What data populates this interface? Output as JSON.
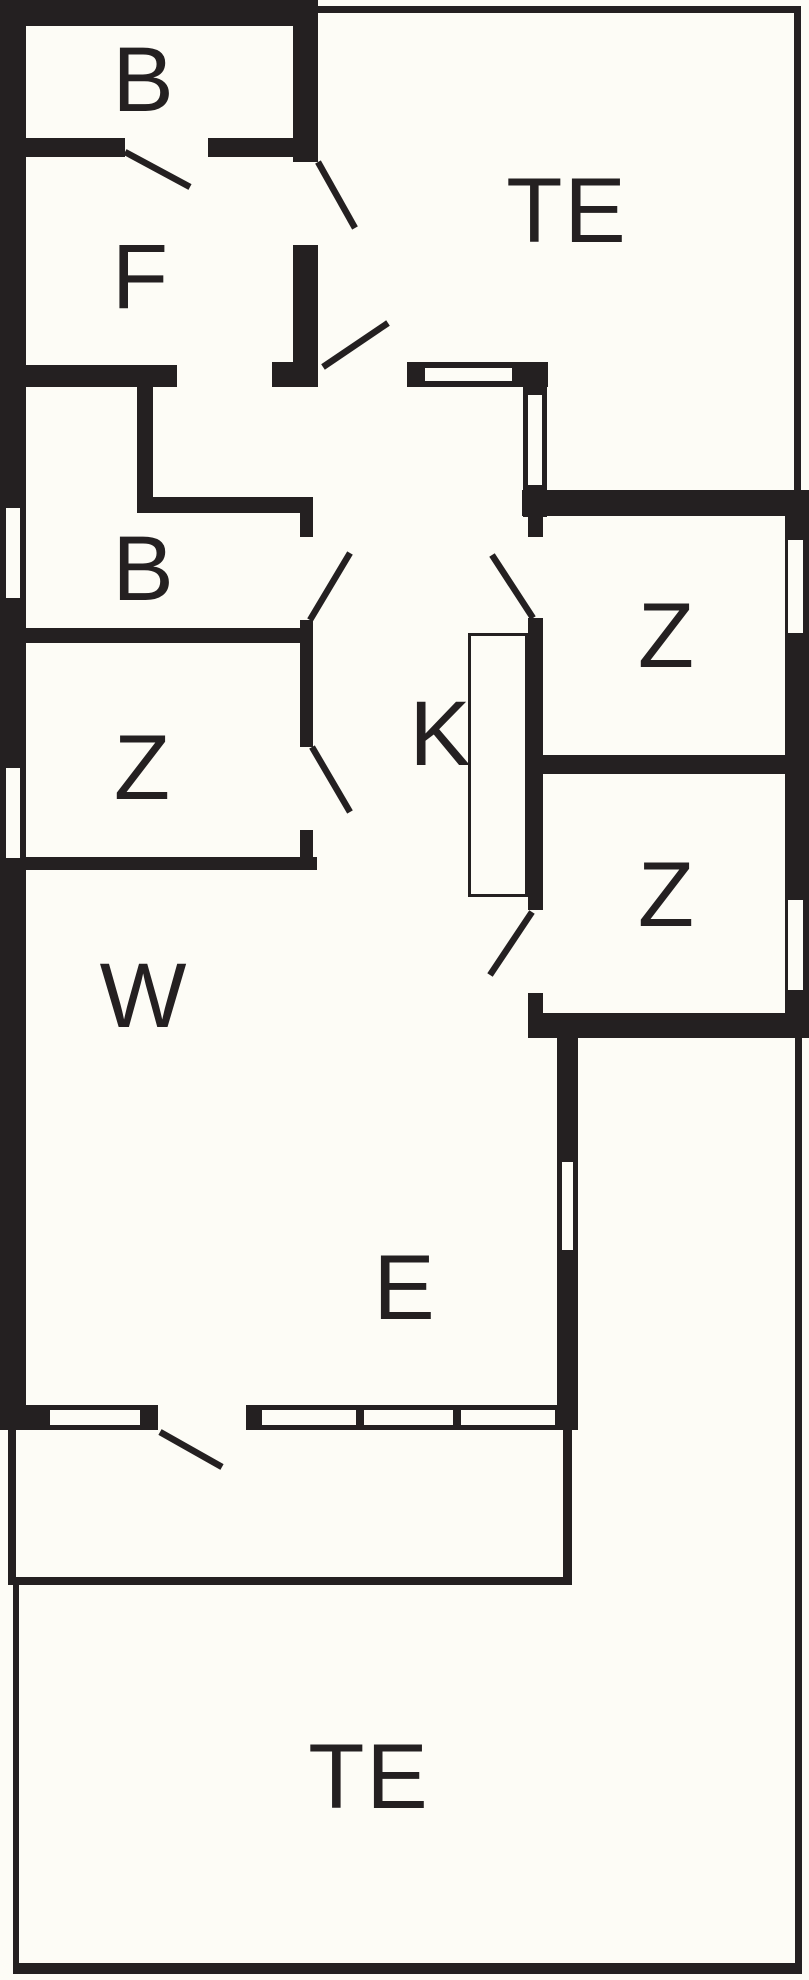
{
  "canvas": {
    "width": 809,
    "height": 1980,
    "background": "#fdfcf6",
    "wall_color": "#242021",
    "label_color": "#242021"
  },
  "rooms": [
    {
      "id": "bathroom-top",
      "label": "B",
      "cx": 144,
      "cy": 80
    },
    {
      "id": "terrace-top",
      "label": "TE",
      "cx": 567,
      "cy": 211
    },
    {
      "id": "utility-room",
      "label": "F",
      "cx": 141,
      "cy": 277
    },
    {
      "id": "bathroom-middle",
      "label": "B",
      "cx": 144,
      "cy": 569
    },
    {
      "id": "bedroom-left",
      "label": "Z",
      "cx": 143,
      "cy": 768
    },
    {
      "id": "kitchen",
      "label": "K",
      "cx": 441,
      "cy": 734
    },
    {
      "id": "bedroom-right-top",
      "label": "Z",
      "cx": 667,
      "cy": 636
    },
    {
      "id": "bedroom-right-bottom",
      "label": "Z",
      "cx": 667,
      "cy": 895
    },
    {
      "id": "living-room",
      "label": "W",
      "cx": 144,
      "cy": 996
    },
    {
      "id": "dining-area",
      "label": "E",
      "cx": 405,
      "cy": 1288
    },
    {
      "id": "terrace-bottom",
      "label": "TE",
      "cx": 369,
      "cy": 1777
    }
  ],
  "floorplan": {
    "walls": [
      {
        "x": 0,
        "y": 0,
        "w": 318,
        "h": 26
      },
      {
        "x": 0,
        "y": 0,
        "w": 26,
        "h": 1430
      },
      {
        "x": 293,
        "y": 26,
        "w": 25,
        "h": 136
      },
      {
        "x": 293,
        "y": 245,
        "w": 25,
        "h": 142
      },
      {
        "x": 25,
        "y": 138,
        "w": 100,
        "h": 19
      },
      {
        "x": 208,
        "y": 138,
        "w": 85,
        "h": 19
      },
      {
        "x": 25,
        "y": 365,
        "w": 152,
        "h": 22
      },
      {
        "x": 272,
        "y": 362,
        "w": 46,
        "h": 25
      },
      {
        "x": 407,
        "y": 362,
        "w": 141,
        "h": 25
      },
      {
        "x": 523,
        "y": 387,
        "w": 24,
        "h": 130
      },
      {
        "x": 522,
        "y": 490,
        "w": 287,
        "h": 26
      },
      {
        "x": 137,
        "y": 382,
        "w": 16,
        "h": 131
      },
      {
        "x": 137,
        "y": 497,
        "w": 176,
        "h": 16
      },
      {
        "x": 300,
        "y": 513,
        "w": 13,
        "h": 24
      },
      {
        "x": 300,
        "y": 620,
        "w": 13,
        "h": 127
      },
      {
        "x": 25,
        "y": 628,
        "w": 288,
        "h": 15
      },
      {
        "x": 300,
        "y": 830,
        "w": 13,
        "h": 40
      },
      {
        "x": 25,
        "y": 857,
        "w": 292,
        "h": 13
      },
      {
        "x": 528,
        "y": 513,
        "w": 15,
        "h": 24
      },
      {
        "x": 528,
        "y": 618,
        "w": 15,
        "h": 292
      },
      {
        "x": 528,
        "y": 993,
        "w": 15,
        "h": 45
      },
      {
        "x": 528,
        "y": 755,
        "w": 257,
        "h": 19
      },
      {
        "x": 785,
        "y": 513,
        "w": 24,
        "h": 525
      },
      {
        "x": 528,
        "y": 1013,
        "w": 281,
        "h": 25
      },
      {
        "x": 557,
        "y": 1038,
        "w": 21,
        "h": 392
      },
      {
        "x": 0,
        "y": 1405,
        "w": 578,
        "h": 25
      },
      {
        "x": 313,
        "y": 6,
        "w": 488,
        "h": 7
      },
      {
        "x": 794,
        "y": 6,
        "w": 7,
        "h": 490
      },
      {
        "x": 795,
        "y": 1038,
        "w": 7,
        "h": 934
      },
      {
        "x": 13,
        "y": 1963,
        "w": 789,
        "h": 11
      },
      {
        "x": 13,
        "y": 1585,
        "w": 6,
        "h": 385
      },
      {
        "x": 8,
        "y": 1430,
        "w": 8,
        "h": 152
      },
      {
        "x": 8,
        "y": 1577,
        "w": 564,
        "h": 8
      },
      {
        "x": 563,
        "y": 1430,
        "w": 9,
        "h": 155
      }
    ],
    "windows": [
      {
        "x": 6,
        "y": 508,
        "w": 14,
        "h": 90
      },
      {
        "x": 6,
        "y": 768,
        "w": 14,
        "h": 90
      },
      {
        "x": 425,
        "y": 368,
        "w": 87,
        "h": 13
      },
      {
        "x": 528,
        "y": 395,
        "w": 14,
        "h": 90
      },
      {
        "x": 788,
        "y": 540,
        "w": 15,
        "h": 93
      },
      {
        "x": 788,
        "y": 900,
        "w": 15,
        "h": 90
      },
      {
        "x": 562,
        "y": 1162,
        "w": 11,
        "h": 88
      },
      {
        "x": 50,
        "y": 1410,
        "w": 90,
        "h": 15
      },
      {
        "x": 262,
        "y": 1410,
        "w": 94,
        "h": 15
      },
      {
        "x": 364,
        "y": 1410,
        "w": 89,
        "h": 15
      },
      {
        "x": 461,
        "y": 1410,
        "w": 94,
        "h": 15
      }
    ],
    "door_openings": [
      {
        "x": 158,
        "y": 1403,
        "w": 88,
        "h": 29
      }
    ],
    "door_swings": [
      {
        "x1": 125,
        "y1": 152,
        "x2": 190,
        "y2": 187
      },
      {
        "x1": 318,
        "y1": 162,
        "x2": 355,
        "y2": 228
      },
      {
        "x1": 323,
        "y1": 367,
        "x2": 388,
        "y2": 323
      },
      {
        "x1": 310,
        "y1": 620,
        "x2": 350,
        "y2": 553
      },
      {
        "x1": 312,
        "y1": 747,
        "x2": 350,
        "y2": 812
      },
      {
        "x1": 533,
        "y1": 618,
        "x2": 492,
        "y2": 555
      },
      {
        "x1": 532,
        "y1": 912,
        "x2": 490,
        "y2": 975
      },
      {
        "x1": 160,
        "y1": 1432,
        "x2": 222,
        "y2": 1467
      }
    ],
    "counter": {
      "x": 468,
      "y": 633,
      "w": 60,
      "h": 264,
      "border": 3
    }
  }
}
